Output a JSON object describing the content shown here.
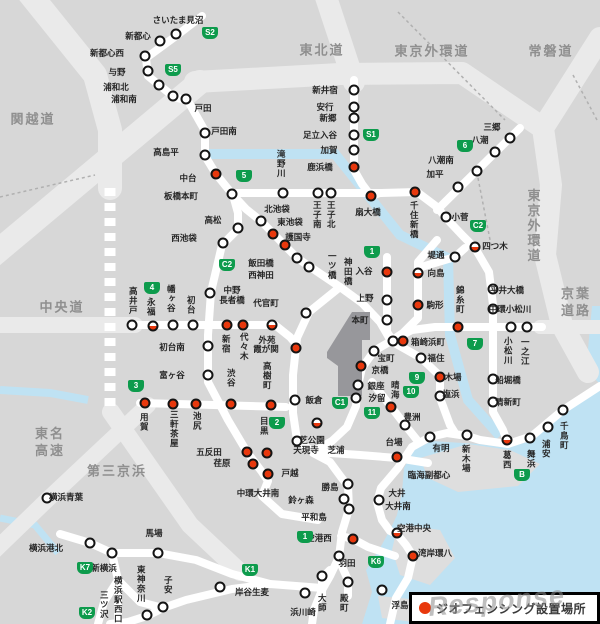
{
  "legend": {
    "label": "ジオフェンシング設置場所",
    "marker_color": "#e8380d"
  },
  "watermark": "Response",
  "colors": {
    "badge_green": "#0d9b4c",
    "marker_red": "#e8380d",
    "water": "#bfe2f3",
    "land": "#d7d7d7",
    "road": "#ffffff"
  },
  "highway_labels": [
    {
      "t": "関越道",
      "x": 33,
      "y": 120
    },
    {
      "t": "東北道",
      "x": 322,
      "y": 51
    },
    {
      "t": "東京外環道",
      "x": 432,
      "y": 52
    },
    {
      "t": "常磐道",
      "x": 551,
      "y": 52
    },
    {
      "t": "中央道",
      "x": 62,
      "y": 308
    },
    {
      "t": "東名\n高速",
      "x": 50,
      "y": 443
    },
    {
      "t": "第三京浜",
      "x": 117,
      "y": 472
    },
    {
      "t": "京葉\n道路",
      "x": 576,
      "y": 303
    },
    {
      "t": "東京外環道",
      "x": 532,
      "y": 226,
      "v": true
    }
  ],
  "badges": [
    {
      "t": "S2",
      "x": 210,
      "y": 33
    },
    {
      "t": "S5",
      "x": 173,
      "y": 70
    },
    {
      "t": "5",
      "x": 244,
      "y": 176
    },
    {
      "t": "S1",
      "x": 371,
      "y": 135
    },
    {
      "t": "6",
      "x": 465,
      "y": 146
    },
    {
      "t": "C2",
      "x": 478,
      "y": 226
    },
    {
      "t": "C2",
      "x": 227,
      "y": 265
    },
    {
      "t": "1",
      "x": 372,
      "y": 252
    },
    {
      "t": "4",
      "x": 152,
      "y": 288
    },
    {
      "t": "3",
      "x": 136,
      "y": 386
    },
    {
      "t": "2",
      "x": 277,
      "y": 423
    },
    {
      "t": "C1",
      "x": 340,
      "y": 403
    },
    {
      "t": "7",
      "x": 475,
      "y": 344
    },
    {
      "t": "9",
      "x": 417,
      "y": 378
    },
    {
      "t": "10",
      "x": 411,
      "y": 392
    },
    {
      "t": "11",
      "x": 372,
      "y": 413
    },
    {
      "t": "B",
      "x": 522,
      "y": 475
    },
    {
      "t": "1",
      "x": 305,
      "y": 537
    },
    {
      "t": "K6",
      "x": 376,
      "y": 562
    },
    {
      "t": "K1",
      "x": 250,
      "y": 570
    },
    {
      "t": "K7",
      "x": 85,
      "y": 568
    },
    {
      "t": "K2",
      "x": 87,
      "y": 613
    }
  ],
  "stations": [
    {
      "n": "さいたま見沼",
      "lx": 178,
      "ly": 20,
      "mx": 176,
      "my": 34,
      "m": "w"
    },
    {
      "n": "新都心",
      "lx": 138,
      "ly": 36,
      "mx": 160,
      "my": 41,
      "m": "w"
    },
    {
      "n": "新都心西",
      "lx": 107,
      "ly": 53,
      "mx": 145,
      "my": 56,
      "m": "w"
    },
    {
      "n": "与野",
      "lx": 117,
      "ly": 72,
      "mx": 148,
      "my": 71,
      "m": "w"
    },
    {
      "n": "浦和北",
      "lx": 116,
      "ly": 87,
      "mx": 159,
      "my": 85,
      "m": "w"
    },
    {
      "n": "浦和南",
      "lx": 124,
      "ly": 99,
      "mx": 173,
      "my": 96,
      "m": "w"
    },
    {
      "n": "戸田",
      "lx": 203,
      "ly": 108,
      "mx": 186,
      "my": 99,
      "m": "w"
    },
    {
      "n": "戸田南",
      "lx": 224,
      "ly": 131,
      "mx": 205,
      "my": 133,
      "m": "w"
    },
    {
      "n": "高島平",
      "lx": 166,
      "ly": 152,
      "mx": 205,
      "my": 155,
      "m": "w"
    },
    {
      "n": "中台",
      "lx": 188,
      "ly": 178,
      "mx": 216,
      "my": 174,
      "m": "r"
    },
    {
      "n": "板橋本町",
      "lx": 181,
      "ly": 196,
      "mx": 232,
      "my": 194,
      "m": "w"
    },
    {
      "n": "高松",
      "lx": 213,
      "ly": 220,
      "mx": 238,
      "my": 228,
      "m": "w"
    },
    {
      "n": "西池袋",
      "lx": 184,
      "ly": 238,
      "mx": 223,
      "my": 243,
      "m": "w"
    },
    {
      "n": "北池袋",
      "lx": 277,
      "ly": 209,
      "mx": 261,
      "my": 221,
      "m": "w"
    },
    {
      "n": "東池袋",
      "lx": 290,
      "ly": 222,
      "mx": 273,
      "my": 234,
      "m": "r"
    },
    {
      "n": "護国寺",
      "lx": 298,
      "ly": 237,
      "mx": 285,
      "my": 245,
      "m": "r"
    },
    {
      "n": "滝野川",
      "o": "v",
      "lx": 281,
      "ly": 164,
      "mx": 283,
      "my": 193,
      "m": "w"
    },
    {
      "n": "王子南",
      "o": "v",
      "lx": 317,
      "ly": 215,
      "mx": 318,
      "my": 193,
      "m": "w"
    },
    {
      "n": "王子北",
      "o": "v",
      "lx": 331,
      "ly": 215,
      "mx": 331,
      "my": 193,
      "m": "w"
    },
    {
      "n": "千住新橋",
      "o": "v",
      "lx": 414,
      "ly": 220,
      "mx": 415,
      "my": 192,
      "m": "r"
    },
    {
      "n": "鹿浜橋",
      "lx": 320,
      "ly": 167,
      "mx": 354,
      "my": 167,
      "m": "r"
    },
    {
      "n": "加賀",
      "lx": 329,
      "ly": 150,
      "mx": 354,
      "my": 150,
      "m": "w"
    },
    {
      "n": "足立入谷",
      "lx": 320,
      "ly": 135,
      "mx": 354,
      "my": 135,
      "m": "w"
    },
    {
      "n": "新郷",
      "lx": 328,
      "ly": 118,
      "mx": 354,
      "my": 118,
      "m": "w"
    },
    {
      "n": "安行",
      "lx": 325,
      "ly": 107,
      "mx": 354,
      "my": 107,
      "m": "w"
    },
    {
      "n": "新井宿",
      "lx": 325,
      "ly": 90,
      "mx": 354,
      "my": 90,
      "m": "w"
    },
    {
      "n": "扇大橋",
      "lx": 368,
      "ly": 212,
      "mx": 371,
      "my": 196,
      "m": "r"
    },
    {
      "n": "三郷",
      "lx": 492,
      "ly": 127,
      "mx": 510,
      "my": 138,
      "m": "w"
    },
    {
      "n": "八潮",
      "lx": 480,
      "ly": 140,
      "mx": 495,
      "my": 152,
      "m": "w"
    },
    {
      "n": "八潮南",
      "lx": 441,
      "ly": 160,
      "mx": 477,
      "my": 171,
      "m": "w"
    },
    {
      "n": "加平",
      "lx": 435,
      "ly": 174,
      "mx": 458,
      "my": 187,
      "m": "w"
    },
    {
      "n": "小菅",
      "lx": 460,
      "ly": 217,
      "mx": 446,
      "my": 217,
      "m": "w"
    },
    {
      "n": "四つ木",
      "lx": 495,
      "ly": 246,
      "mx": 475,
      "my": 247,
      "m": "h"
    },
    {
      "n": "堤通",
      "lx": 436,
      "ly": 255,
      "mx": 455,
      "my": 257,
      "m": "w"
    },
    {
      "n": "向島",
      "lx": 436,
      "ly": 273,
      "mx": 418,
      "my": 273,
      "m": "h"
    },
    {
      "n": "入谷",
      "lx": 364,
      "ly": 271,
      "mx": 387,
      "my": 272,
      "m": "r"
    },
    {
      "n": "上野",
      "lx": 365,
      "ly": 298,
      "mx": 387,
      "my": 300,
      "m": "w"
    },
    {
      "n": "本町",
      "lx": 360,
      "ly": 320,
      "mx": 387,
      "my": 320,
      "m": "w"
    },
    {
      "n": "一ツ橋",
      "o": "v",
      "lx": 332,
      "ly": 266
    },
    {
      "n": "神田橋",
      "o": "v",
      "lx": 348,
      "ly": 272
    },
    {
      "n": "飯田橋",
      "lx": 261,
      "ly": 263,
      "mx": 297,
      "my": 258,
      "m": "w"
    },
    {
      "n": "西神田",
      "lx": 261,
      "ly": 275,
      "mx": 309,
      "my": 267,
      "m": "w"
    },
    {
      "n": "中野\n長者橋",
      "lx": 232,
      "ly": 295,
      "mx": 210,
      "my": 293,
      "m": "w"
    },
    {
      "n": "代官町",
      "lx": 266,
      "ly": 303,
      "mx": 306,
      "my": 313,
      "m": "w"
    },
    {
      "n": "駒形",
      "lx": 435,
      "ly": 305,
      "mx": 418,
      "my": 305,
      "m": "r"
    },
    {
      "n": "錦糸町",
      "o": "v",
      "lx": 460,
      "ly": 300,
      "mx": 458,
      "my": 327,
      "m": "r"
    },
    {
      "n": "平井大橋",
      "lx": 507,
      "ly": 290,
      "mx": 493,
      "my": 289,
      "m": "w"
    },
    {
      "n": "中環小松川",
      "lx": 510,
      "ly": 309,
      "mx": 493,
      "my": 309,
      "m": "w"
    },
    {
      "n": "小松川",
      "o": "v",
      "lx": 508,
      "ly": 351,
      "mx": 511,
      "my": 327,
      "m": "w"
    },
    {
      "n": "一之江",
      "o": "v",
      "lx": 525,
      "ly": 352,
      "mx": 527,
      "my": 327,
      "m": "w"
    },
    {
      "n": "箱崎浜町",
      "lx": 428,
      "ly": 342,
      "mx": 403,
      "my": 341,
      "m": "r"
    },
    {
      "n": "福住",
      "lx": 436,
      "ly": 358,
      "mx": 421,
      "my": 358,
      "m": "w"
    },
    {
      "n": "宝町",
      "lx": 386,
      "ly": 358,
      "mx": 374,
      "my": 351,
      "m": "w"
    },
    {
      "n": "京橋",
      "lx": 380,
      "ly": 370,
      "mx": 361,
      "my": 366,
      "m": "r"
    },
    {
      "n": "銀座",
      "lx": 376,
      "ly": 386,
      "mx": 358,
      "my": 385,
      "m": "w"
    },
    {
      "n": "汐留",
      "lx": 377,
      "ly": 398,
      "mx": 356,
      "my": 398,
      "m": "w"
    },
    {
      "n": "晴海",
      "o": "v",
      "lx": 395,
      "ly": 390
    },
    {
      "n": "豊洲",
      "lx": 412,
      "ly": 417,
      "mx": 405,
      "my": 425,
      "m": "w"
    },
    {
      "n": "木場",
      "lx": 453,
      "ly": 377,
      "mx": 440,
      "my": 377,
      "m": "r"
    },
    {
      "n": "塩浜",
      "lx": 451,
      "ly": 394,
      "mx": 440,
      "my": 396,
      "m": "w"
    },
    {
      "n": "飯倉",
      "lx": 314,
      "ly": 400,
      "mx": 295,
      "my": 400,
      "m": "w"
    },
    {
      "n": "芝公園",
      "lx": 312,
      "ly": 440,
      "mx": 297,
      "my": 441,
      "m": "w"
    },
    {
      "n": "天現寺",
      "lx": 306,
      "ly": 450
    },
    {
      "n": "芝浦",
      "lx": 336,
      "ly": 450
    },
    {
      "n": "船堀橋",
      "lx": 508,
      "ly": 380,
      "mx": 493,
      "my": 379,
      "m": "w"
    },
    {
      "n": "清新町",
      "lx": 508,
      "ly": 402,
      "mx": 493,
      "my": 402,
      "m": "w"
    },
    {
      "n": "葛西",
      "o": "v",
      "lx": 507,
      "ly": 460,
      "mx": 507,
      "my": 440,
      "m": "h"
    },
    {
      "n": "舞浜",
      "o": "v",
      "lx": 531,
      "ly": 459,
      "mx": 530,
      "my": 438,
      "m": "w"
    },
    {
      "n": "浦安",
      "o": "v",
      "lx": 546,
      "ly": 449,
      "mx": 548,
      "my": 427,
      "m": "w"
    },
    {
      "n": "千鳥町",
      "o": "v",
      "lx": 564,
      "ly": 436,
      "mx": 563,
      "my": 410,
      "m": "w"
    },
    {
      "n": "臨海副都心",
      "lx": 429,
      "ly": 475
    },
    {
      "n": "有明",
      "lx": 441,
      "ly": 448,
      "mx": 430,
      "my": 437,
      "m": "w"
    },
    {
      "n": "新木場",
      "o": "v",
      "lx": 466,
      "ly": 459,
      "mx": 467,
      "my": 435,
      "m": "w"
    },
    {
      "n": "台場",
      "lx": 394,
      "ly": 442,
      "mx": 397,
      "my": 457,
      "m": "r"
    },
    {
      "n": "高井戸",
      "o": "v",
      "lx": 133,
      "ly": 301,
      "mx": 132,
      "my": 325,
      "m": "w"
    },
    {
      "n": "永福",
      "o": "v",
      "lx": 151,
      "ly": 307,
      "mx": 153,
      "my": 326,
      "m": "h"
    },
    {
      "n": "幡ヶ谷",
      "o": "v",
      "lx": 171,
      "ly": 299,
      "mx": 173,
      "my": 325,
      "m": "w"
    },
    {
      "n": "初台",
      "o": "v",
      "lx": 191,
      "ly": 305,
      "mx": 193,
      "my": 325,
      "m": "w"
    },
    {
      "n": "初台南",
      "lx": 172,
      "ly": 347,
      "mx": 208,
      "my": 346,
      "m": "w"
    },
    {
      "n": "富ヶ谷",
      "lx": 172,
      "ly": 375,
      "mx": 208,
      "my": 375,
      "m": "w"
    },
    {
      "n": "新宿",
      "o": "v",
      "lx": 226,
      "ly": 344,
      "mx": 227,
      "my": 325,
      "m": "r"
    },
    {
      "n": "代々木",
      "o": "v",
      "lx": 244,
      "ly": 347,
      "mx": 243,
      "my": 325,
      "m": "r"
    },
    {
      "n": "外苑",
      "lx": 267,
      "ly": 340,
      "mx": 272,
      "my": 325,
      "m": "h"
    },
    {
      "n": "霞が関",
      "lx": 266,
      "ly": 349,
      "mx": 296,
      "my": 348,
      "m": "r"
    },
    {
      "n": "渋谷",
      "o": "v",
      "lx": 231,
      "ly": 378,
      "mx": 231,
      "my": 404,
      "m": "r"
    },
    {
      "n": "高樹町",
      "o": "v",
      "lx": 267,
      "ly": 376,
      "mx": 271,
      "my": 405,
      "m": "r"
    },
    {
      "n": "用賀",
      "o": "v",
      "lx": 144,
      "ly": 422,
      "mx": 145,
      "my": 403,
      "m": "r"
    },
    {
      "n": "三軒茶屋",
      "o": "v",
      "lx": 174,
      "ly": 429,
      "mx": 173,
      "my": 404,
      "m": "r"
    },
    {
      "n": "池尻",
      "o": "v",
      "lx": 197,
      "ly": 421,
      "mx": 196,
      "my": 404,
      "m": "r"
    },
    {
      "n": "目黒",
      "o": "v",
      "lx": 264,
      "ly": 426
    },
    {
      "n": "五反田",
      "lx": 209,
      "ly": 452,
      "mx": 247,
      "my": 452,
      "m": "r"
    },
    {
      "n": "荏原",
      "lx": 222,
      "ly": 463,
      "mx": 253,
      "my": 464,
      "m": "r"
    },
    {
      "n": "戸越",
      "lx": 290,
      "ly": 473,
      "mx": 268,
      "my": 474,
      "m": "r"
    },
    {
      "n": "中環大井南",
      "lx": 258,
      "ly": 493
    },
    {
      "n": "勝島",
      "lx": 330,
      "ly": 487,
      "mx": 348,
      "my": 484,
      "m": "w"
    },
    {
      "n": "鈴ヶ森",
      "lx": 301,
      "ly": 500,
      "mx": 344,
      "my": 499,
      "m": "w"
    },
    {
      "n": "平和島",
      "lx": 314,
      "ly": 517,
      "mx": 349,
      "my": 509,
      "m": "w"
    },
    {
      "n": "大井",
      "lx": 397,
      "ly": 493,
      "mx": 379,
      "my": 500,
      "m": "w"
    },
    {
      "n": "大井南",
      "lx": 398,
      "ly": 506
    },
    {
      "n": "空港中央",
      "lx": 414,
      "ly": 528,
      "mx": 397,
      "my": 533,
      "m": "h"
    },
    {
      "n": "湾岸環八",
      "lx": 435,
      "ly": 553,
      "mx": 413,
      "my": 556,
      "m": "r"
    },
    {
      "n": "空港西",
      "lx": 319,
      "ly": 538,
      "mx": 353,
      "my": 539,
      "m": "r"
    },
    {
      "n": "羽田",
      "lx": 347,
      "ly": 563,
      "mx": 339,
      "my": 556,
      "m": "w"
    },
    {
      "n": "大師",
      "o": "v",
      "lx": 322,
      "ly": 603
    },
    {
      "n": "殿町",
      "o": "v",
      "lx": 344,
      "ly": 603
    },
    {
      "n": "浮島",
      "lx": 400,
      "ly": 605,
      "mx": 382,
      "my": 590,
      "m": "w"
    },
    {
      "n": "浜川崎",
      "lx": 303,
      "ly": 612,
      "mx": 305,
      "my": 593,
      "m": "w"
    },
    {
      "n": "岸谷生麦",
      "lx": 252,
      "ly": 592,
      "mx": 220,
      "my": 587,
      "m": "w"
    },
    {
      "n": "馬場",
      "lx": 154,
      "ly": 533,
      "mx": 158,
      "my": 553,
      "m": "w"
    },
    {
      "n": "横浜港北",
      "lx": 46,
      "ly": 548,
      "mx": 90,
      "my": 543,
      "m": "w"
    },
    {
      "n": "新横浜",
      "lx": 104,
      "ly": 568,
      "mx": 112,
      "my": 553,
      "m": "w"
    },
    {
      "n": "横浜駅西口",
      "o": "v",
      "lx": 118,
      "ly": 600
    },
    {
      "n": "東神奈川",
      "o": "v",
      "lx": 141,
      "ly": 584
    },
    {
      "n": "子安",
      "o": "v",
      "lx": 168,
      "ly": 585
    },
    {
      "n": "三ツ沢",
      "o": "v",
      "lx": 104,
      "ly": 605
    },
    {
      "n": "横浜青葉",
      "lx": 66,
      "ly": 497,
      "mx": 47,
      "my": 498,
      "m": "w"
    }
  ],
  "extra_markers": [
    {
      "x": 393,
      "y": 341,
      "m": "w"
    },
    {
      "x": 267,
      "y": 453,
      "m": "r"
    },
    {
      "x": 317,
      "y": 423,
      "m": "h"
    },
    {
      "x": 391,
      "y": 407,
      "m": "r"
    },
    {
      "x": 322,
      "y": 576,
      "m": "w"
    },
    {
      "x": 348,
      "y": 582,
      "m": "w"
    },
    {
      "x": 147,
      "y": 615,
      "m": "w"
    },
    {
      "x": 163,
      "y": 607,
      "m": "w"
    }
  ]
}
